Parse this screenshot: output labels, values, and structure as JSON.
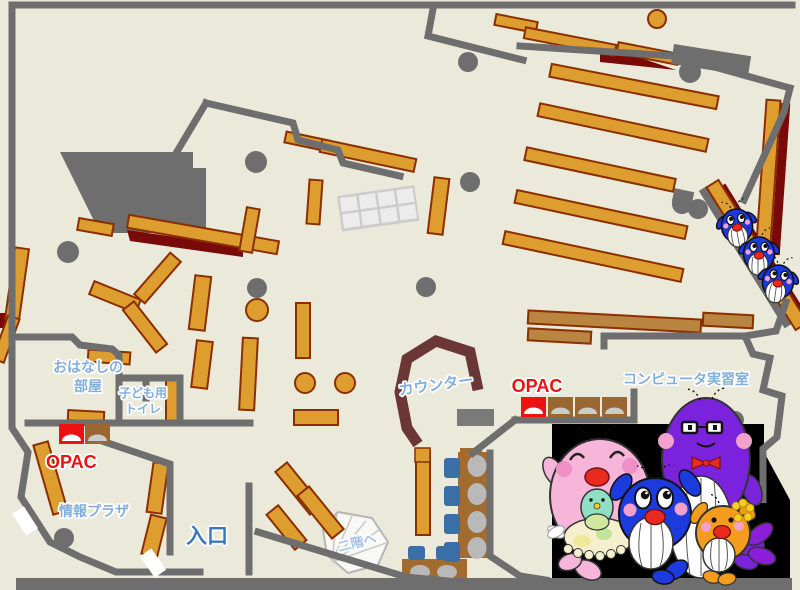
{
  "map_title": "library-first-floor-map",
  "labels": {
    "storytelling_room_line1": "おはなしの",
    "storytelling_room_line2": "部屋",
    "kids_toilet_line1": "子ども用",
    "kids_toilet_line2": "トイレ",
    "opac_left": "OPAC",
    "opac_center": "OPAC",
    "info_plaza": "情報プラザ",
    "entrance": "入口",
    "counter": "カウンター",
    "computer_room": "コンピュータ実習室",
    "to_second_floor": "二階へ"
  },
  "fixtures": {
    "opac_left_terminals": 2,
    "opac_center_terminals": 4,
    "computer_desk_chairs": 6,
    "stairs": "fan-shaped-staircase"
  },
  "mascots": {
    "sliding_top_right": [
      "small-blue-whale",
      "small-blue-whale",
      "small-blue-whale"
    ],
    "family_bottom_right": [
      "pink-whale-parent-with-baby",
      "purple-whale-parent-glasses-bowtie",
      "blue-whale-child",
      "orange-whale-child-flower"
    ]
  },
  "colors": {
    "floor": "#EBE9DA",
    "wall": "#6E6E6E",
    "shelf": "#DE9E2F",
    "shelf_border": "#8B2F00",
    "accent_maroon": "#7A0A0A",
    "counter": "#6A3636",
    "desk_brown": "#A26B2F",
    "table_brown": "#BA8540",
    "chair_blue": "#3A6FA8",
    "monitor_gray": "#B9B9B9",
    "label_blue": "#82AEDC",
    "entrance_blue": "#3B74C4",
    "opac_red": "#EA1212",
    "stairs_blue": "#A5C2E4",
    "panel_black": "#000000",
    "mascot_pink": "#F8B5DA",
    "mascot_blue": "#1C3BDE",
    "mascot_purple": "#7B22DC",
    "mascot_orange": "#F49C1C",
    "mascot_teal_baby": "#8FDFC4",
    "mouth_red": "#E92A1F",
    "cheek_pink": "#F2A0CC",
    "tail_purple": "#8B1FD9"
  }
}
